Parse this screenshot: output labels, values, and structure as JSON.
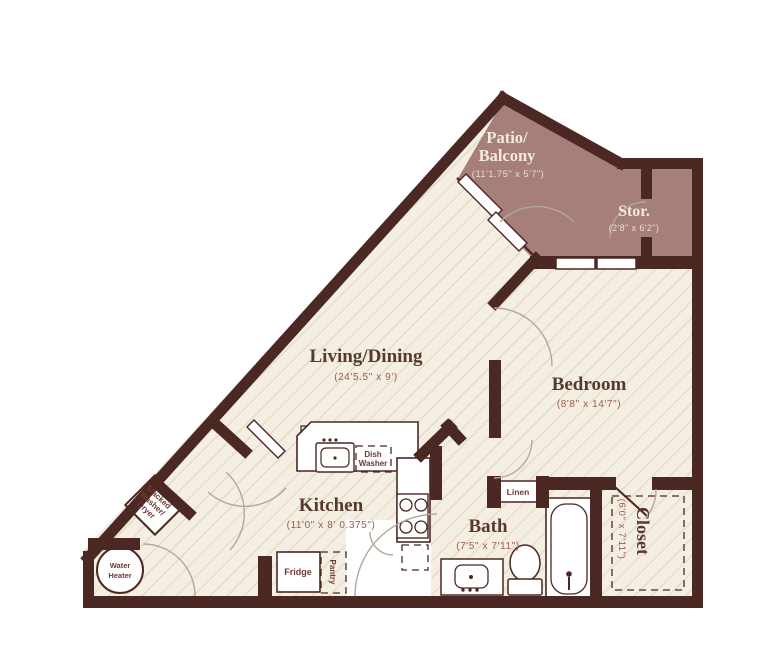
{
  "plan": {
    "colors": {
      "wall": "#4b2823",
      "floor": "#f4eee3",
      "hatch": "#e3dbc9",
      "patio": "#a67e7a",
      "title_dark": "#573a2f",
      "dim_dark": "#9d5b4d",
      "title_light": "#f4ebdf",
      "dim_light": "#ecdbd2",
      "fixture_label": "#6e3a31"
    },
    "rooms": {
      "patio": {
        "name_line1": "Patio/",
        "name_line2": "Balcony",
        "dims": "(11'1.75\" x 5'7\")"
      },
      "storage": {
        "name": "Stor.",
        "dims": "(2'8\" x 6'2\")"
      },
      "living_dining": {
        "name": "Living/Dining",
        "dims": "(24'5.5\" x 9')"
      },
      "bedroom": {
        "name": "Bedroom",
        "dims": "(8'8\" x 14'7\")"
      },
      "kitchen": {
        "name": "Kitchen",
        "dims": "(11'0\" x 8' 0.375\")"
      },
      "bath": {
        "name": "Bath",
        "dims": "(7'5\" x 7'11\")"
      },
      "closet": {
        "name": "Closet",
        "dims": "(6'0\" x 7'11\")"
      }
    },
    "fixtures": {
      "dishwasher_line1": "Dish",
      "dishwasher_line2": "Washer",
      "fridge": "Fridge",
      "pantry": "Pantry",
      "linen": "Linen",
      "water_heater_line1": "Water",
      "water_heater_line2": "Heater",
      "washer_dryer_line1": "Stacked",
      "washer_dryer_line2": "Washer/",
      "washer_dryer_line3": "Dryer"
    }
  }
}
